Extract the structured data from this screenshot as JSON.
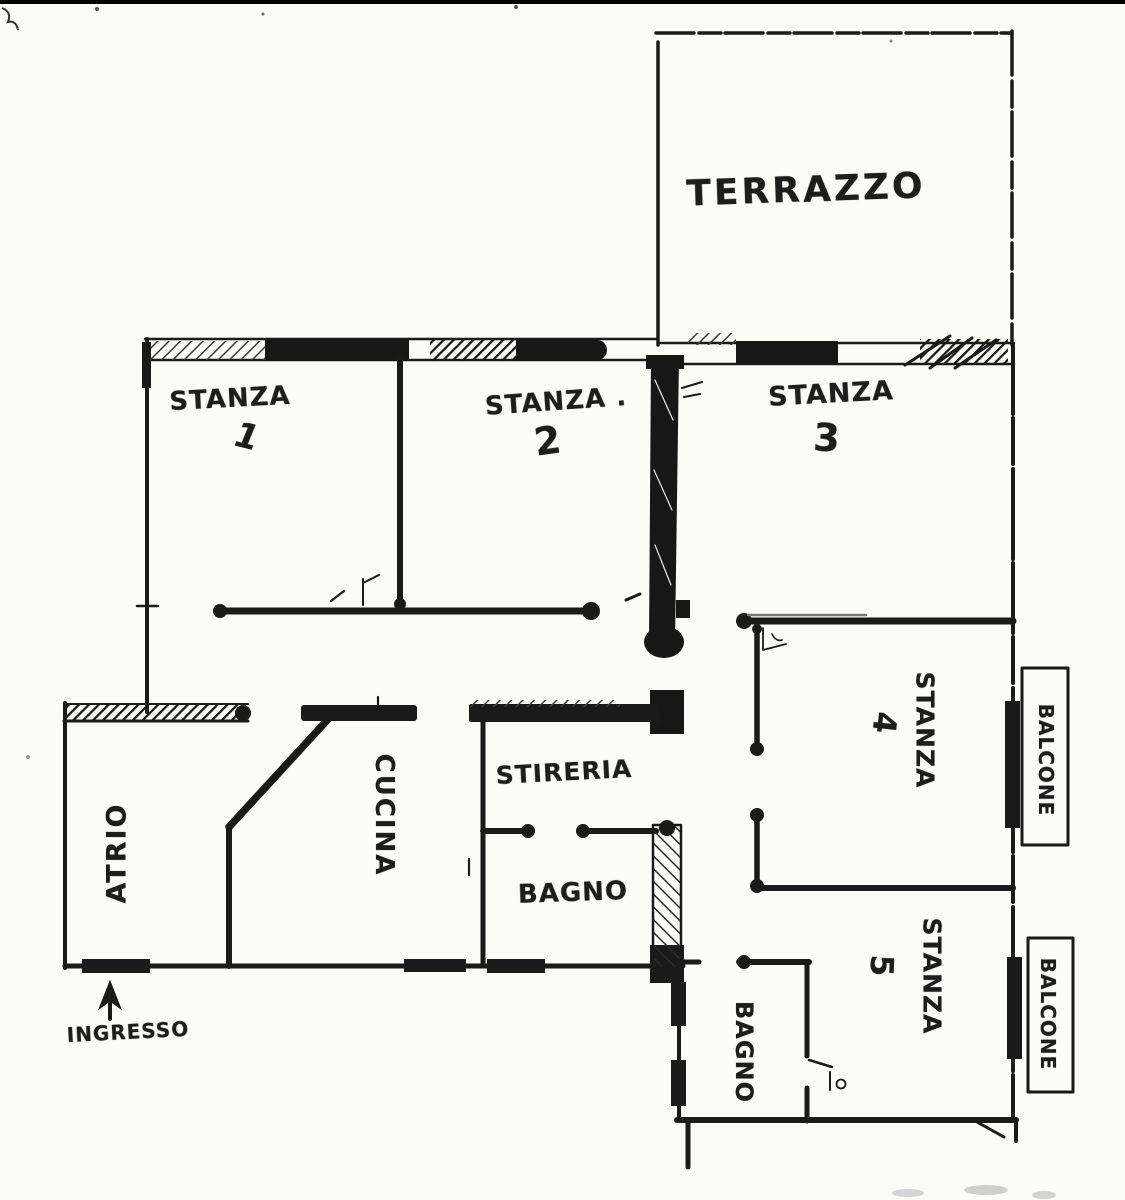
{
  "plan": {
    "type": "hand-drawn apartment floor plan",
    "ink_color": "#1a1a1a",
    "paper_color": "#fbfbfa",
    "rooms": [
      {
        "id": "terrazzo",
        "label": "TERRAZZO",
        "number": ""
      },
      {
        "id": "stanza-1",
        "label": "STANZA",
        "number": "1"
      },
      {
        "id": "stanza-2",
        "label": "STANZA .",
        "number": "2"
      },
      {
        "id": "stanza-3",
        "label": "STANZA",
        "number": "3"
      },
      {
        "id": "stanza-4",
        "label": "STANZA",
        "number": "4"
      },
      {
        "id": "stanza-5",
        "label": "STANZA",
        "number": "5"
      },
      {
        "id": "cucina",
        "label": "CUCINA",
        "number": ""
      },
      {
        "id": "stireria",
        "label": "STIRERIA",
        "number": ""
      },
      {
        "id": "bagno-1",
        "label": "BAGNO",
        "number": ""
      },
      {
        "id": "atrio",
        "label": "ATRIO",
        "number": ""
      },
      {
        "id": "bagno-2",
        "label": "BAGNO",
        "number": ""
      },
      {
        "id": "balcone-1",
        "label": "BALCONE",
        "number": ""
      },
      {
        "id": "balcone-2",
        "label": "BALCONE",
        "number": ""
      }
    ],
    "entrance": {
      "label": "INGRESSO"
    }
  }
}
